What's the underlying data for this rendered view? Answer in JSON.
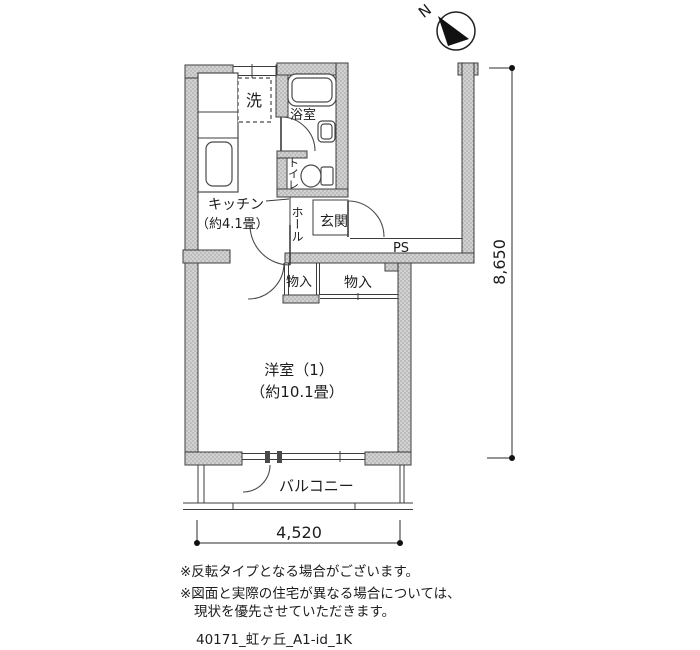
{
  "compass": {
    "north_label": "N"
  },
  "labels": {
    "washer": "洗",
    "bath": "浴室",
    "toilet": "トイレ",
    "kitchen": "キッチン",
    "kitchen_size": "（約4.1畳）",
    "hall": "ホール",
    "entrance": "玄関",
    "pipe_space": "PS",
    "closet_left": "物入",
    "closet_right": "物入",
    "living_room": "洋室（1）",
    "living_room_size": "（約10.1畳）",
    "balcony": "バルコニー"
  },
  "dimensions": {
    "width_mm": "4,520",
    "height_mm": "8,650"
  },
  "notes": [
    "※反転タイプとなる場合がございます。",
    "※図面と実際の住宅が異なる場合については、",
    "現状を優先させていただきます。"
  ],
  "footer_id": "40171_虹ヶ丘_A1-id_1K",
  "colors": {
    "wall_fill": "#d2d2d2",
    "wall_dot": "#9b9b9b",
    "line": "#3c3c3c",
    "arrow": "#111111"
  }
}
